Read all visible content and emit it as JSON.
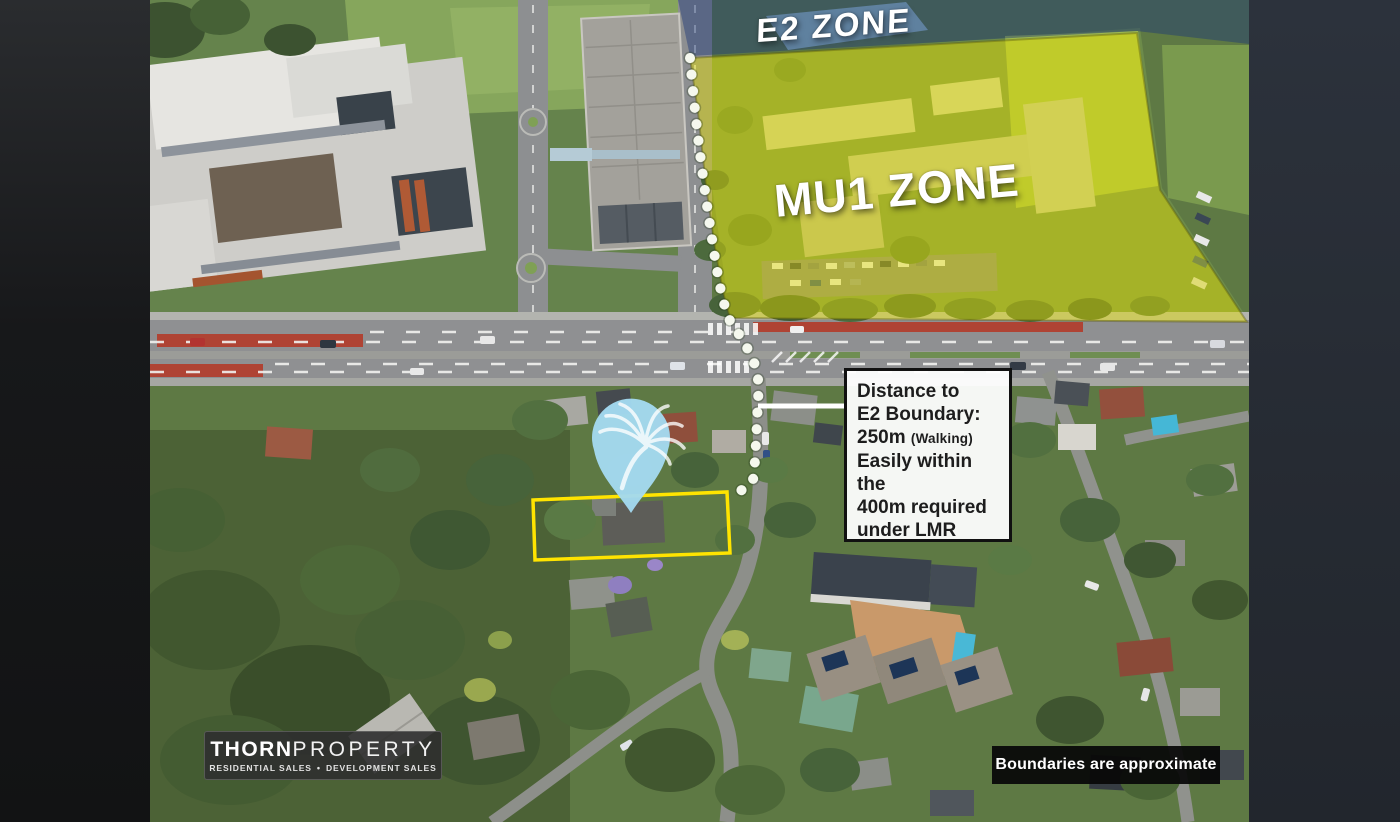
{
  "zones": {
    "e2_label": "E2 ZONE",
    "mu1_label": "MU1 ZONE"
  },
  "callout": {
    "line1": "Distance to",
    "line2": "E2 Boundary:",
    "line3_value": "250m",
    "line3_note": "(Walking)",
    "line4": "Easily within the",
    "line5": "400m required",
    "line6": "under LMR"
  },
  "branding": {
    "name_bold": "THORN",
    "name_light": "PROPERTY",
    "tagline_left": "RESIDENTIAL SALES",
    "tagline_sep": "•",
    "tagline_right": "DEVELOPMENT SALES"
  },
  "disclaimer": {
    "text": "Boundaries are approximate"
  },
  "map_icons": {
    "pin": "palm-tree-pin",
    "route": "walking-route-dotted-line"
  },
  "colors": {
    "mu1_overlay": "rgba(233,227,0,0.45)",
    "e2_overlay": "rgba(28,56,120,0.45)",
    "e2_panel": "rgba(125,168,228,0.5)",
    "pin_fill": "#a3daf0",
    "property_outline": "#ffe400",
    "dotted_line": "#f5f8ee",
    "leader_line": "#ffffff"
  }
}
